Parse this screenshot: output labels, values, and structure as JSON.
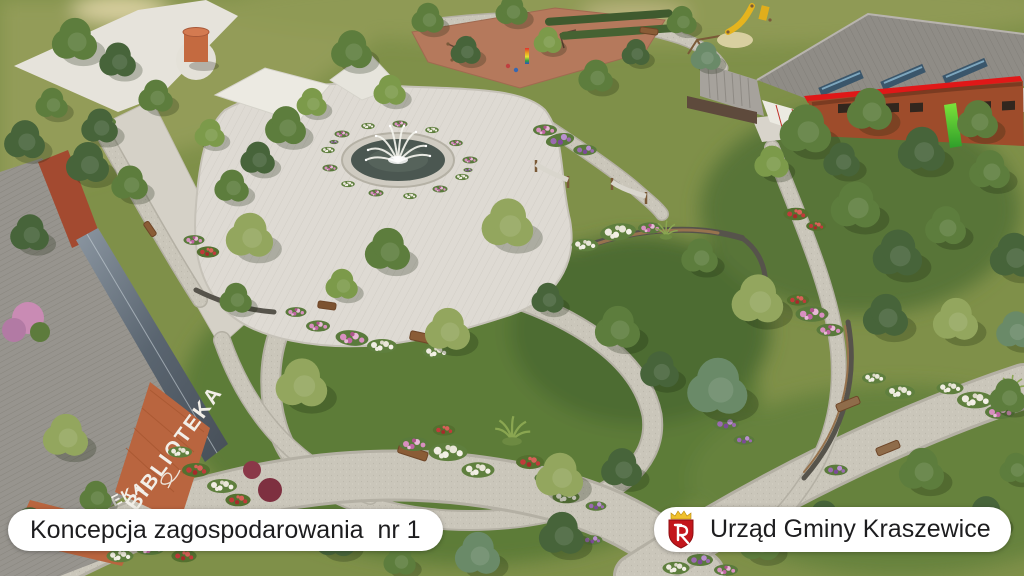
{
  "scene": {
    "kind": "aerial architectural render of a park concept",
    "description": "Bird's-eye 3D visualization: central fountain plaza, looping gravel paths, flower beds, lawns, library building (left), school building with red roof edge (top right), playgrounds and hammocks"
  },
  "captions": {
    "left": "Koncepcja zagospodarowania  nr 1",
    "right": "Urząd Gminy Kraszewice"
  },
  "buildings": {
    "library_label": "BIBLIOTEKA"
  },
  "icons": {
    "crest": "kraszewice-coat-of-arms"
  },
  "colors": {
    "caption_bg": "#ffffff",
    "caption_text": "#1d1d1f",
    "crest_red": "#c3161c",
    "crest_gold": "#f0c12e",
    "roof_accent_red": "#e01818",
    "grass_base": "#7f9049",
    "lawn_olive": "#939c58",
    "path_gravel": "#cac6ba",
    "plaza_paving": "#dedad3",
    "fountain_water": "#4b5751",
    "brick": "#9e4c2b"
  }
}
